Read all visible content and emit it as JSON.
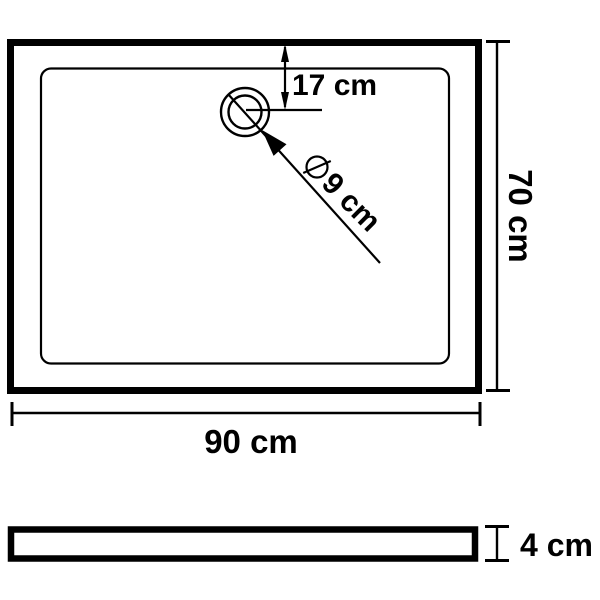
{
  "colors": {
    "line": "#000000",
    "background": "#ffffff"
  },
  "top_view": {
    "drain_offset_label": "17 cm",
    "drain_diameter_symbol": "⌀",
    "drain_diameter_label": "9 cm",
    "height_label": "70 cm",
    "width_label": "90 cm"
  },
  "side_view": {
    "thickness_label": "4 cm"
  }
}
